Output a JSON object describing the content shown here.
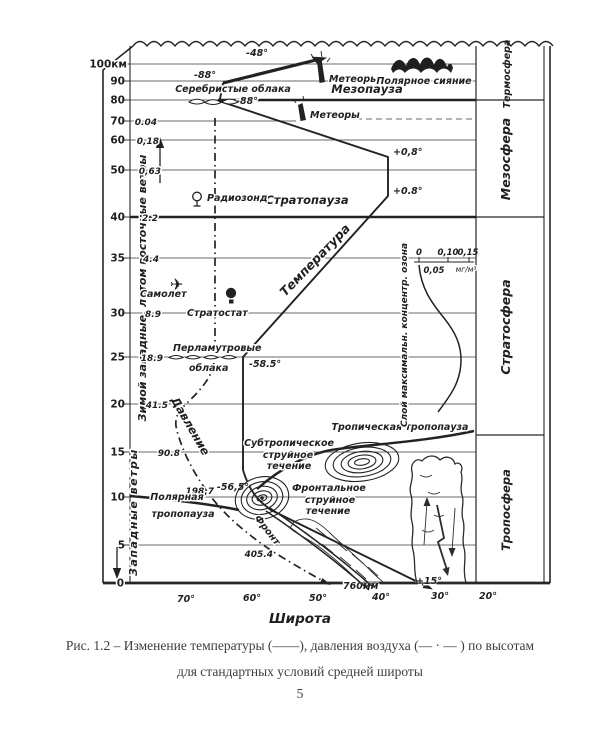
{
  "caption": {
    "line1": "Рис. 1.2 – Изменение температуры (——), давления воздуха (— · — ) по высотам",
    "line2": "для стандартных условий средней широты",
    "page_number": "5"
  },
  "axes": {
    "x_label": "Широта",
    "x_ticks": [
      "70°",
      "60°",
      "50°",
      "40°",
      "30°",
      "20°"
    ],
    "y_top_label": "100км",
    "y_ticks": [
      "90",
      "80",
      "70",
      "60",
      "50",
      "40",
      "35",
      "30",
      "25",
      "20",
      "15",
      "10",
      "5",
      "0"
    ]
  },
  "pressure_values": [
    "0.04",
    "0,18",
    "0,63",
    "2.2",
    "4.4",
    "8.9",
    "18.9",
    "41.5",
    "90.8",
    "198,7",
    "405.4"
  ],
  "temperature_values": {
    "t_100km": "-48°",
    "t_90km": "-88°",
    "t_80km": "-88°",
    "t_55km": "+0,8°",
    "t_45km": "+0.8°",
    "t_25km": "-58.5°",
    "t_tropopause": "-56,5°",
    "t_surface": "+15°"
  },
  "surface_pressure": "760мм",
  "curve_labels": {
    "temperature": "Температура",
    "pressure": "Давление"
  },
  "layers": {
    "thermosphere": "Термосфера",
    "mesosphere": "Мезосфера",
    "stratosphere": "Стратосфера",
    "troposphere": "Тропосфера"
  },
  "boundaries": {
    "mesopause": "Мезопауза",
    "stratopause": "Стратопауза",
    "tropical_tropopause": "Тропическая тропопауза",
    "polar_tropopause_line1": "Полярная",
    "polar_tropopause_line2": "тропопауза"
  },
  "winds": {
    "upper": "Зимой западные, летом восточные ветры",
    "lower": "Западные ветры"
  },
  "ozone": {
    "layer_label": "Слой максимальн. концентр. озона",
    "scale_ticks": [
      "0",
      "0,10",
      "0,15"
    ],
    "scale_mid": "0,05",
    "units": "мг/м³"
  },
  "phenomena": {
    "meteors_upper": "Метеоры",
    "meteors_lower": "Метеоры",
    "aurora": "Полярное сияние",
    "noctilucent_clouds": "Серебристые облака",
    "nacreous_line1": "Перламутровые",
    "nacreous_line2": "облака",
    "radiosonde": "Радиозонд",
    "airplane": "Самолет",
    "stratostat": "Стратостат",
    "subtropical_jet": [
      "Субтропическое",
      "струйное",
      "течение"
    ],
    "frontal_jet": [
      "Фронтальное",
      "струйное",
      "течение"
    ],
    "front": "Фронт"
  }
}
